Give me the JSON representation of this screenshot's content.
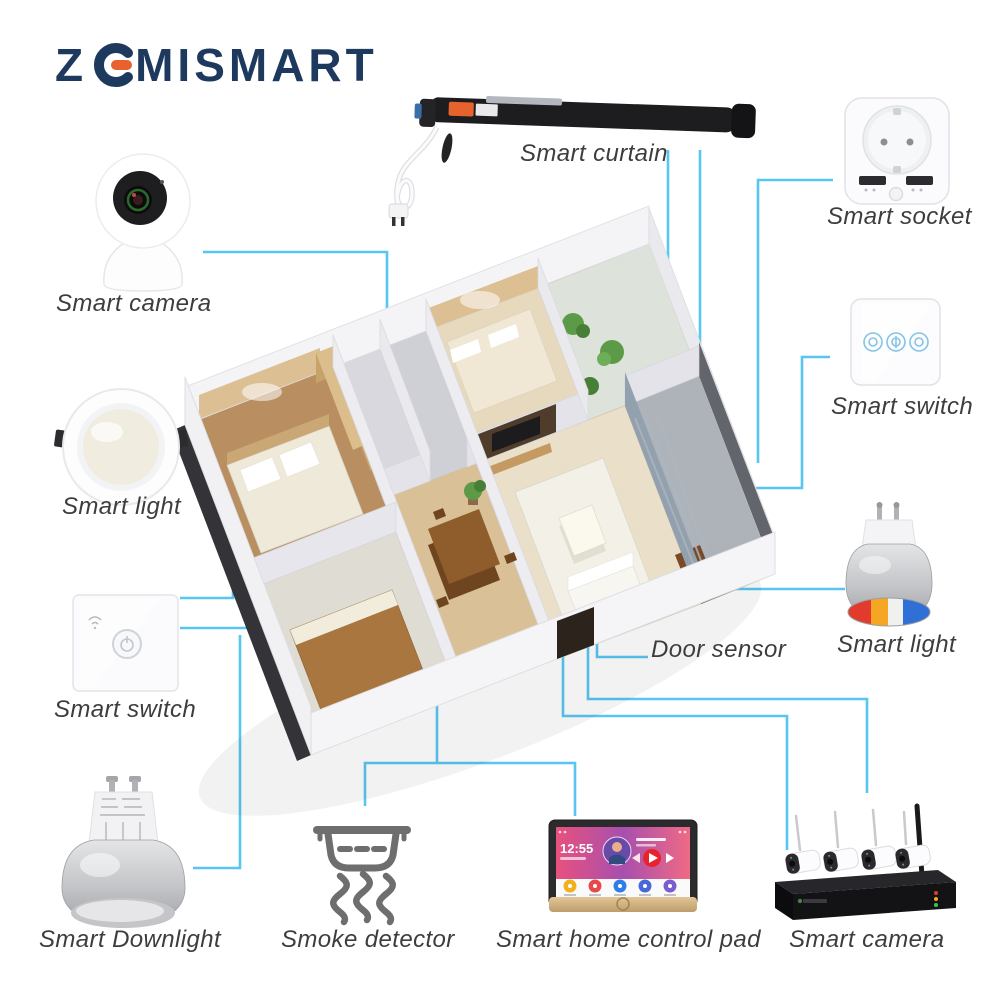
{
  "brand": {
    "logo_z": "Z",
    "logo_rest": "MISMART",
    "navy": "#1d3a5e",
    "orange": "#e8622d"
  },
  "labels": {
    "curtain": "Smart curtain",
    "socket": "Smart socket",
    "camera_top": "Smart camera",
    "light_left": "Smart light",
    "switch_left": "Smart switch",
    "switch_right": "Smart switch",
    "light_right": "Smart light",
    "door_sensor": "Door sensor",
    "downlight": "Smart Downlight",
    "smoke": "Smoke detector",
    "pad": "Smart home control pad",
    "camera_bottom": "Smart camera"
  },
  "pad": {
    "time": "12:55"
  },
  "colors": {
    "connector": "#58c6f1",
    "label_text": "#3d3d3d",
    "logo_navy": "#1d3a5e",
    "logo_orange": "#e8622d"
  },
  "icons": {
    "wifi": "wifi-icon",
    "power": "power-icon",
    "play": "play-icon",
    "prev": "prev-icon",
    "next": "next-icon",
    "smoke": "smoke-detector-icon"
  }
}
